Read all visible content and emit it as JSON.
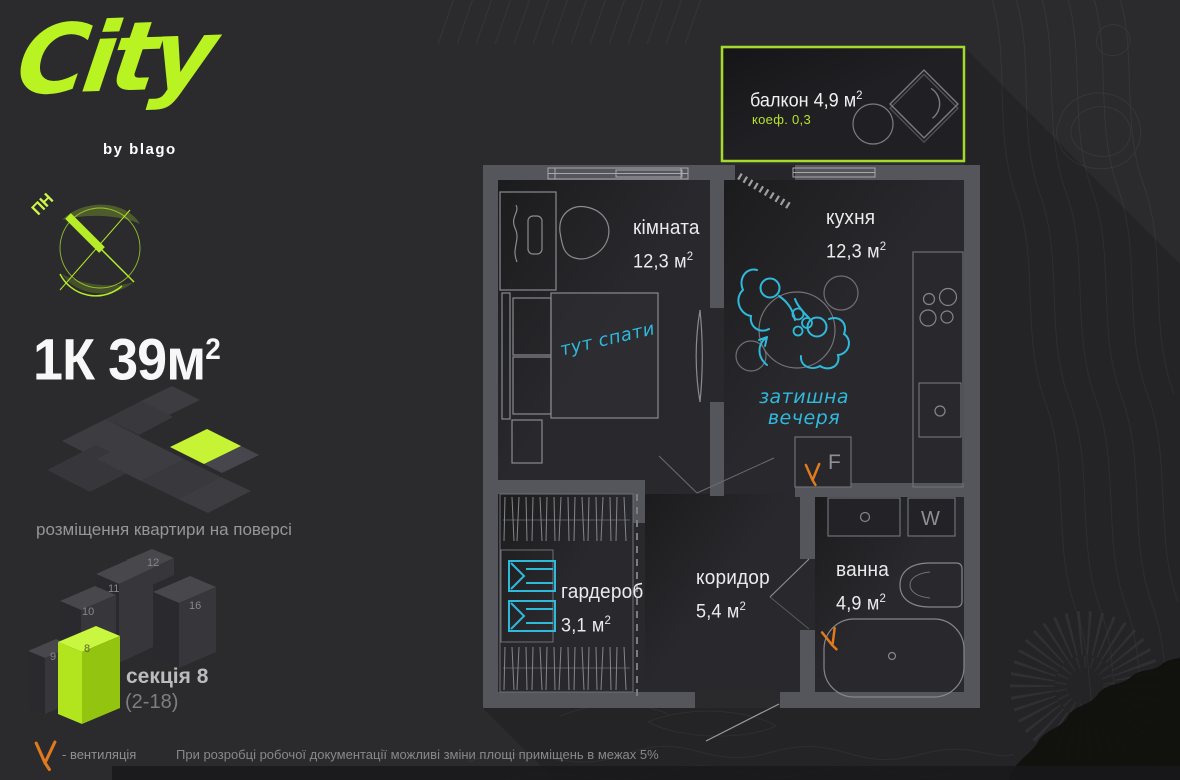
{
  "brand": {
    "name": "City",
    "byline": "by blago"
  },
  "compass": {
    "north_label": "ПН"
  },
  "headline": {
    "text": "1К 39м",
    "sup": "2"
  },
  "floor_plate": {
    "caption": "розміщення квартири на поверсі"
  },
  "section": {
    "title": "секція 8",
    "floors_range": "(2-18)",
    "highlight_number": "8",
    "numbers": [
      "9",
      "10",
      "11",
      "12",
      "16"
    ]
  },
  "legend": {
    "vent_label": "- вентиляція",
    "disclaimer": "При розробці робочої документації можливі зміни площі приміщень в межах 5%"
  },
  "plan": {
    "balcony": {
      "label": "балкон",
      "area": "4,9 м",
      "sup": "2",
      "coef": "коеф. 0,3"
    },
    "room": {
      "label": "кімната",
      "area": "12,3 м",
      "sup": "2"
    },
    "kitchen": {
      "label": "кухня",
      "area": "12,3 м",
      "sup": "2"
    },
    "wardrobe": {
      "label": "гардероб",
      "area": "3,1 м",
      "sup": "2"
    },
    "corridor": {
      "label": "коридор",
      "area": "5,4 м",
      "sup": "2"
    },
    "bathroom": {
      "label": "ванна",
      "area": "4,9 м",
      "sup": "2"
    },
    "notes": {
      "sleep": "тут спати",
      "dinner": "затишна вечеря"
    },
    "appliances": {
      "fridge": "F",
      "washer": "W"
    }
  },
  "colors": {
    "lime": "#b9f322",
    "cyan": "#2fb9db",
    "orange": "#e07a1e",
    "background": "#2b2b2e",
    "wall": "#55565b"
  }
}
